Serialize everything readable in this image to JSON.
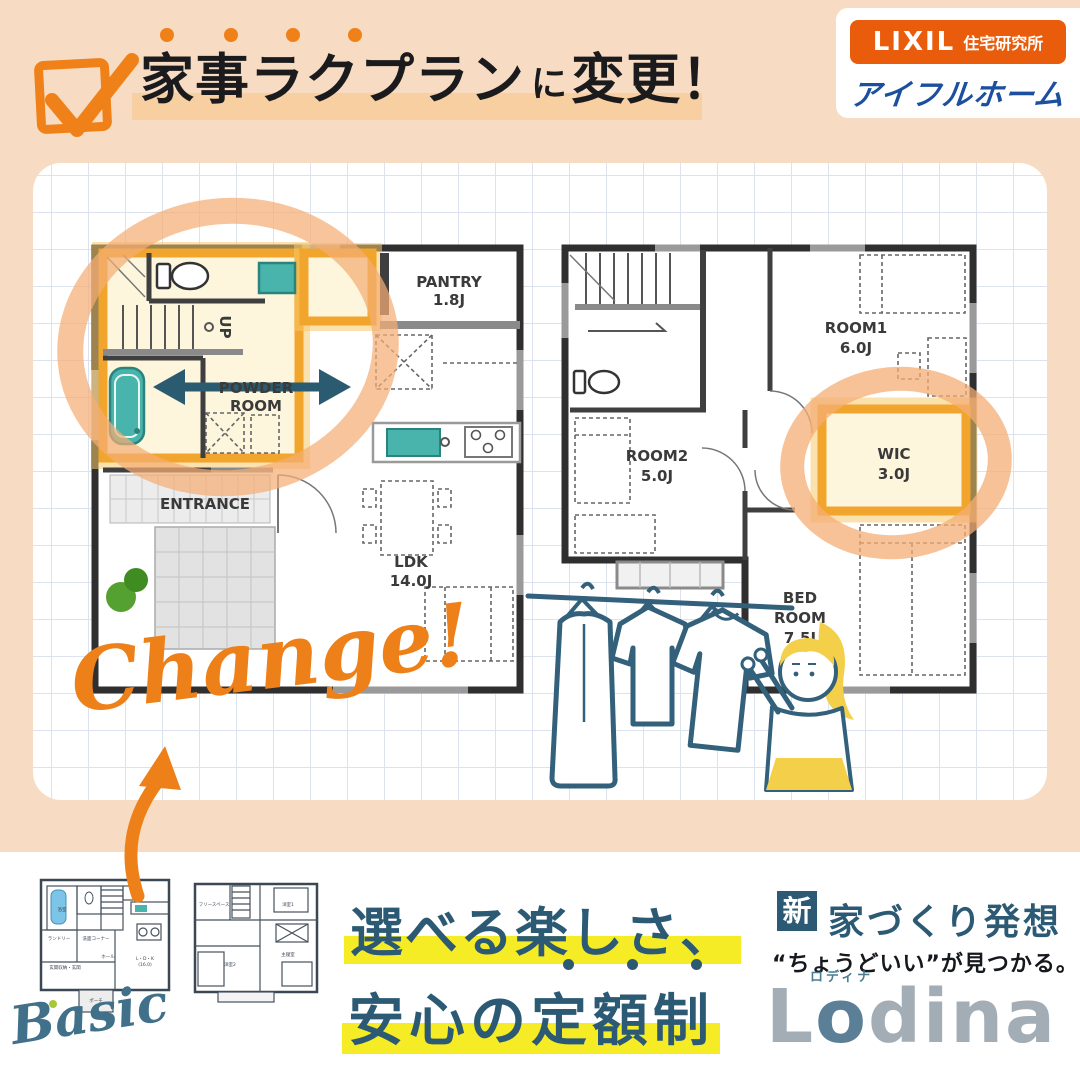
{
  "header": {
    "title_main": "家事ラクプラン",
    "title_particle": "に",
    "title_tail": "変更！",
    "logo_lixil": "LIXIL",
    "logo_lixil_sub": "住宅研究所",
    "logo_brand": "アイフルホーム"
  },
  "plan1f": {
    "pantry_name": "PANTRY",
    "pantry_size": "1.8J",
    "powder_line1": "POWDER",
    "powder_line2": "ROOM",
    "entrance": "ENTRANCE",
    "ldk_name": "LDK",
    "ldk_size": "14.0J",
    "stairs": "UP"
  },
  "plan2f": {
    "room1_name": "ROOM1",
    "room1_size": "6.0J",
    "room2_name": "ROOM2",
    "room2_size": "5.0J",
    "wic_name": "WIC",
    "wic_size": "3.0J",
    "bed_line1": "BED",
    "bed_line2": "ROOM",
    "bed_size": "7.5J"
  },
  "annotation": {
    "change": "Change!",
    "basic": "Basic"
  },
  "mini_plans": {
    "p1_bath": "浴室",
    "p1_laundry": "ランドリー",
    "p1_counter": "洗面コーナー",
    "p1_storage": "玄関収納・玄関",
    "p1_hall": "ホール",
    "p1_ldk": "L・D・K",
    "p1_ldk_size": "(16.0)",
    "p1_porch": "ポーチ",
    "p2_free": "フリースペース",
    "p2_room1": "洋室1",
    "p2_room2": "洋室2",
    "p2_main": "主寝室"
  },
  "footer": {
    "slogan1": "選べる楽しさ、",
    "slogan2": "安心の定額制",
    "badge": "新",
    "concept": "家づくり発想",
    "tagline": "“ちょうどいい”が見つかる。",
    "brand_l": "L",
    "brand_o": "o",
    "brand_rest": "dina",
    "brand_ruby": "ロディナ"
  },
  "colors": {
    "background_peach": "#f7dcc3",
    "accent_orange": "#ef8118",
    "lixil_orange": "#e95c0c",
    "brand_blue": "#1c4f9e",
    "teal_text": "#2c5a74",
    "teal_line": "#33607a",
    "highlight_yellow": "#f6ec26",
    "room_highlight_amber": "#f1a52c",
    "room_highlight_fill": "#fdf6dd",
    "ring_orange": "#f4ad74",
    "fixture_teal": "#49b4ab"
  }
}
